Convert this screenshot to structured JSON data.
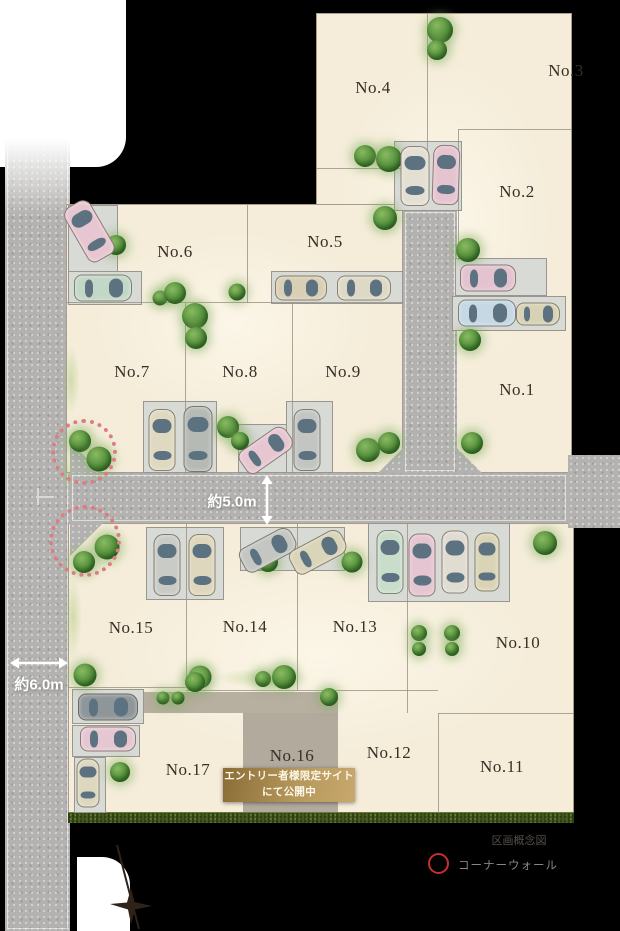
{
  "page": {
    "title": "区画概念図"
  },
  "legend": {
    "map_type_label": "区画概念図",
    "corner_wall_label": "コーナーウォール",
    "corner_wall_color": "#c5302c"
  },
  "banner": {
    "line1": "エントリー者様限定サイト",
    "line2": "にて公開中"
  },
  "measurements": {
    "center_road_width": "約5.0m",
    "left_road_width": "約6.0m"
  },
  "lots": [
    {
      "no": "No.1",
      "x": 517,
      "y": 390
    },
    {
      "no": "No.2",
      "x": 517,
      "y": 192
    },
    {
      "no": "No.3",
      "x": 566,
      "y": 71
    },
    {
      "no": "No.4",
      "x": 373,
      "y": 88
    },
    {
      "no": "No.5",
      "x": 325,
      "y": 242
    },
    {
      "no": "No.6",
      "x": 175,
      "y": 252
    },
    {
      "no": "No.7",
      "x": 132,
      "y": 372
    },
    {
      "no": "No.8",
      "x": 240,
      "y": 372
    },
    {
      "no": "No.9",
      "x": 343,
      "y": 372
    },
    {
      "no": "No.10",
      "x": 518,
      "y": 643
    },
    {
      "no": "No.11",
      "x": 502,
      "y": 767
    },
    {
      "no": "No.12",
      "x": 389,
      "y": 753
    },
    {
      "no": "No.13",
      "x": 355,
      "y": 627
    },
    {
      "no": "No.14",
      "x": 245,
      "y": 627
    },
    {
      "no": "No.15",
      "x": 131,
      "y": 628
    },
    {
      "no": "No.16",
      "x": 292,
      "y": 756
    },
    {
      "no": "No.17",
      "x": 188,
      "y": 770
    }
  ],
  "map": {
    "white_areas": [
      {
        "x": 0,
        "y": 0,
        "w": 126,
        "h": 167,
        "radius": "0 0 30px 0"
      },
      {
        "x": 77,
        "y": 857,
        "w": 53,
        "h": 74,
        "radius": "0 28px 0 0"
      }
    ],
    "roads": [
      {
        "x": 5,
        "y": 128,
        "w": 65,
        "h": 803
      },
      {
        "x": 70,
        "y": 473,
        "w": 498,
        "h": 50
      },
      {
        "x": 568,
        "y": 455,
        "w": 52,
        "h": 73
      },
      {
        "x": 403,
        "y": 210,
        "w": 54,
        "h": 263
      }
    ],
    "road_fade": {
      "x": 5,
      "y": 128,
      "w": 65,
      "h": 88
    },
    "blocks": [
      {
        "x": 316,
        "y": 13,
        "w": 256,
        "h": 460
      },
      {
        "x": 66,
        "y": 204,
        "w": 337,
        "h": 269
      },
      {
        "x": 68,
        "y": 523,
        "w": 506,
        "h": 290
      }
    ],
    "chamfers": [
      {
        "x": 378,
        "y": 448,
        "w": 25,
        "h": 25,
        "clip": "polygon(0 100%,100% 100%,100% 0)"
      },
      {
        "x": 457,
        "y": 448,
        "w": 25,
        "h": 25,
        "clip": "polygon(0 0,0 100%,100% 100%)"
      },
      {
        "x": 70,
        "y": 440,
        "w": 30,
        "h": 33,
        "clip": "polygon(0 0,0 100%,100% 100%)"
      },
      {
        "x": 70,
        "y": 523,
        "w": 33,
        "h": 33,
        "clip": "polygon(0 0,100% 0,0 100%)"
      }
    ],
    "driveway": {
      "x": 142,
      "y": 692,
      "w": 196,
      "h": 21
    },
    "no16_pad": {
      "x": 243,
      "y": 713,
      "w": 95,
      "h": 100
    },
    "hedge": {
      "x": 68,
      "y": 812,
      "w": 506,
      "h": 11
    },
    "parking_pads": [
      {
        "x": 68,
        "y": 205,
        "w": 50,
        "h": 70
      },
      {
        "x": 68,
        "y": 271,
        "w": 74,
        "h": 34
      },
      {
        "x": 271,
        "y": 271,
        "w": 132,
        "h": 33
      },
      {
        "x": 394,
        "y": 141,
        "w": 68,
        "h": 70
      },
      {
        "x": 455,
        "y": 258,
        "w": 92,
        "h": 38
      },
      {
        "x": 452,
        "y": 296,
        "w": 114,
        "h": 35
      },
      {
        "x": 143,
        "y": 401,
        "w": 74,
        "h": 72
      },
      {
        "x": 238,
        "y": 424,
        "w": 57,
        "h": 49
      },
      {
        "x": 286,
        "y": 401,
        "w": 47,
        "h": 72
      },
      {
        "x": 146,
        "y": 527,
        "w": 78,
        "h": 73
      },
      {
        "x": 240,
        "y": 527,
        "w": 105,
        "h": 44
      },
      {
        "x": 368,
        "y": 523,
        "w": 142,
        "h": 79
      },
      {
        "x": 72,
        "y": 689,
        "w": 72,
        "h": 35
      },
      {
        "x": 72,
        "y": 725,
        "w": 68,
        "h": 32
      },
      {
        "x": 74,
        "y": 757,
        "w": 32,
        "h": 56
      }
    ],
    "cars": [
      {
        "cx": 89,
        "cy": 231,
        "w": 30,
        "l": 62,
        "rot": -30,
        "color": "#e7c6d1"
      },
      {
        "cx": 103,
        "cy": 288,
        "w": 27,
        "l": 58,
        "rot": 90,
        "color": "#c3d7c7"
      },
      {
        "cx": 301,
        "cy": 288,
        "w": 25,
        "l": 52,
        "rot": 90,
        "color": "#d9cfb5"
      },
      {
        "cx": 364,
        "cy": 288,
        "w": 25,
        "l": 54,
        "rot": 90,
        "color": "#ded9c4"
      },
      {
        "cx": 415,
        "cy": 176,
        "w": 29,
        "l": 60,
        "rot": 0,
        "color": "#e4dfd3"
      },
      {
        "cx": 446,
        "cy": 175,
        "w": 27,
        "l": 60,
        "rot": 2,
        "color": "#e5c4d0"
      },
      {
        "cx": 488,
        "cy": 278,
        "w": 27,
        "l": 56,
        "rot": 90,
        "color": "#e3c3cf"
      },
      {
        "cx": 487,
        "cy": 313,
        "w": 27,
        "l": 58,
        "rot": 90,
        "color": "#c6d8e4"
      },
      {
        "cx": 538,
        "cy": 314,
        "w": 23,
        "l": 44,
        "rot": 90,
        "color": "#d7d2b3"
      },
      {
        "cx": 162,
        "cy": 440,
        "w": 27,
        "l": 62,
        "rot": 0,
        "color": "#ded9c0"
      },
      {
        "cx": 198,
        "cy": 439,
        "w": 29,
        "l": 66,
        "rot": 0,
        "color": "#b6bab5"
      },
      {
        "cx": 266,
        "cy": 450,
        "w": 27,
        "l": 56,
        "rot": 55,
        "color": "#e6c7d1"
      },
      {
        "cx": 307,
        "cy": 440,
        "w": 27,
        "l": 62,
        "rot": 0,
        "color": "#c2c5c2"
      },
      {
        "cx": 167,
        "cy": 565,
        "w": 27,
        "l": 62,
        "rot": 0,
        "color": "#c9cbc6"
      },
      {
        "cx": 202,
        "cy": 565,
        "w": 27,
        "l": 62,
        "rot": 0,
        "color": "#ded7bd"
      },
      {
        "cx": 268,
        "cy": 550,
        "w": 27,
        "l": 58,
        "rot": 62,
        "color": "#c3c6c1"
      },
      {
        "cx": 318,
        "cy": 552,
        "w": 27,
        "l": 58,
        "rot": 62,
        "color": "#dad4b9"
      },
      {
        "cx": 390,
        "cy": 562,
        "w": 27,
        "l": 64,
        "rot": 0,
        "color": "#c9ddca"
      },
      {
        "cx": 422,
        "cy": 565,
        "w": 27,
        "l": 63,
        "rot": 0,
        "color": "#e5c5d1"
      },
      {
        "cx": 455,
        "cy": 562,
        "w": 27,
        "l": 63,
        "rot": 0,
        "color": "#e1dcd1"
      },
      {
        "cx": 487,
        "cy": 562,
        "w": 25,
        "l": 59,
        "rot": 0,
        "color": "#dad4b7"
      },
      {
        "cx": 108,
        "cy": 707,
        "w": 27,
        "l": 60,
        "rot": 90,
        "color": "#8e969a"
      },
      {
        "cx": 108,
        "cy": 739,
        "w": 25,
        "l": 56,
        "rot": 90,
        "color": "#e5c7d2"
      },
      {
        "cx": 88,
        "cy": 783,
        "w": 23,
        "l": 49,
        "rot": 0,
        "color": "#ddd7be"
      }
    ],
    "trees": [
      {
        "cx": 440,
        "cy": 30,
        "d": 26
      },
      {
        "cx": 437,
        "cy": 50,
        "d": 20
      },
      {
        "cx": 365,
        "cy": 156,
        "d": 22
      },
      {
        "cx": 389,
        "cy": 159,
        "d": 26
      },
      {
        "cx": 385,
        "cy": 218,
        "d": 24
      },
      {
        "cx": 116,
        "cy": 245,
        "d": 20
      },
      {
        "cx": 160,
        "cy": 298,
        "d": 15
      },
      {
        "cx": 175,
        "cy": 293,
        "d": 22
      },
      {
        "cx": 237,
        "cy": 292,
        "d": 17
      },
      {
        "cx": 195,
        "cy": 316,
        "d": 26
      },
      {
        "cx": 196,
        "cy": 338,
        "d": 22
      },
      {
        "cx": 468,
        "cy": 250,
        "d": 24
      },
      {
        "cx": 470,
        "cy": 340,
        "d": 22
      },
      {
        "cx": 472,
        "cy": 443,
        "d": 22
      },
      {
        "cx": 80,
        "cy": 441,
        "d": 22
      },
      {
        "cx": 99,
        "cy": 459,
        "d": 25
      },
      {
        "cx": 107,
        "cy": 547,
        "d": 25
      },
      {
        "cx": 84,
        "cy": 562,
        "d": 22
      },
      {
        "cx": 368,
        "cy": 450,
        "d": 24
      },
      {
        "cx": 389,
        "cy": 443,
        "d": 22
      },
      {
        "cx": 228,
        "cy": 427,
        "d": 22
      },
      {
        "cx": 240,
        "cy": 441,
        "d": 18
      },
      {
        "cx": 268,
        "cy": 562,
        "d": 20
      },
      {
        "cx": 352,
        "cy": 562,
        "d": 21
      },
      {
        "cx": 85,
        "cy": 675,
        "d": 23
      },
      {
        "cx": 200,
        "cy": 677,
        "d": 23
      },
      {
        "cx": 263,
        "cy": 679,
        "d": 16
      },
      {
        "cx": 284,
        "cy": 677,
        "d": 24
      },
      {
        "cx": 329,
        "cy": 697,
        "d": 18
      },
      {
        "cx": 545,
        "cy": 543,
        "d": 24
      },
      {
        "cx": 419,
        "cy": 633,
        "d": 16
      },
      {
        "cx": 452,
        "cy": 633,
        "d": 16
      },
      {
        "cx": 419,
        "cy": 649,
        "d": 14
      },
      {
        "cx": 452,
        "cy": 649,
        "d": 14
      },
      {
        "cx": 163,
        "cy": 698,
        "d": 13
      },
      {
        "cx": 178,
        "cy": 698,
        "d": 13
      },
      {
        "cx": 120,
        "cy": 772,
        "d": 20
      },
      {
        "cx": 195,
        "cy": 682,
        "d": 20
      }
    ],
    "boundary_lines": [
      {
        "x": 427,
        "y": 14,
        "w": 1,
        "h": 155
      },
      {
        "x": 316,
        "y": 168,
        "w": 87,
        "h": 1
      },
      {
        "x": 458,
        "y": 129,
        "w": 114,
        "h": 1
      },
      {
        "x": 458,
        "y": 129,
        "w": 1,
        "h": 131
      },
      {
        "x": 247,
        "y": 205,
        "w": 1,
        "h": 98
      },
      {
        "x": 66,
        "y": 302,
        "w": 337,
        "h": 1
      },
      {
        "x": 185,
        "y": 303,
        "w": 1,
        "h": 170
      },
      {
        "x": 292,
        "y": 303,
        "w": 1,
        "h": 170
      },
      {
        "x": 452,
        "y": 330,
        "w": 114,
        "h": 1
      },
      {
        "x": 186,
        "y": 523,
        "w": 1,
        "h": 164
      },
      {
        "x": 297,
        "y": 523,
        "w": 1,
        "h": 167
      },
      {
        "x": 407,
        "y": 523,
        "w": 1,
        "h": 190
      },
      {
        "x": 68,
        "y": 687,
        "w": 118,
        "h": 1
      },
      {
        "x": 186,
        "y": 690,
        "w": 252,
        "h": 1
      },
      {
        "x": 438,
        "y": 713,
        "w": 1,
        "h": 100
      },
      {
        "x": 438,
        "y": 713,
        "w": 136,
        "h": 1
      }
    ],
    "road_marks": [
      {
        "x": 36,
        "y": 496,
        "w": 18,
        "h": 2
      },
      {
        "x": 37,
        "y": 488,
        "w": 2,
        "h": 17
      }
    ],
    "grass": [
      {
        "x": 62,
        "y": 345,
        "w": 18,
        "h": 70
      },
      {
        "x": 64,
        "y": 575,
        "w": 18,
        "h": 85
      },
      {
        "x": 215,
        "y": 668,
        "w": 95,
        "h": 20
      },
      {
        "x": 60,
        "y": 452,
        "w": 14,
        "h": 42
      }
    ],
    "corner_walls": [
      {
        "cx": 84,
        "cy": 452,
        "r": 33
      },
      {
        "cx": 85,
        "cy": 541,
        "r": 36
      }
    ],
    "compass": {
      "x": 108,
      "y": 840
    }
  }
}
